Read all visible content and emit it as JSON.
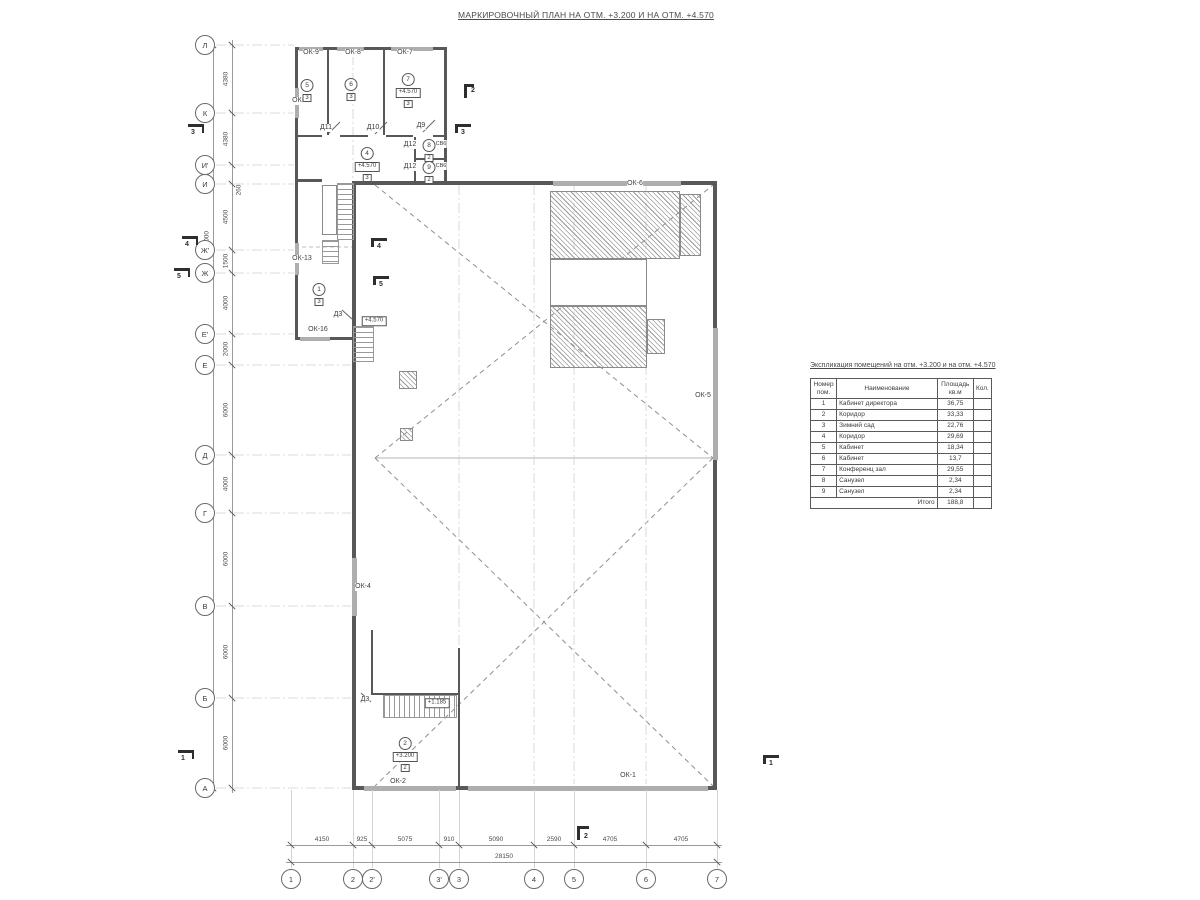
{
  "drawing_title": "МАРКИРОВОЧНЫЙ ПЛАН НА ОТМ. +3.200 И НА ОТМ. +4.570",
  "axes": {
    "left": [
      {
        "label": "Л",
        "y": 45
      },
      {
        "label": "К",
        "y": 113
      },
      {
        "label": "И'",
        "y": 165
      },
      {
        "label": "И",
        "y": 184
      },
      {
        "label": "Ж'",
        "y": 250
      },
      {
        "label": "Ж",
        "y": 273
      },
      {
        "label": "Е'",
        "y": 334
      },
      {
        "label": "Е",
        "y": 365
      },
      {
        "label": "Д",
        "y": 455
      },
      {
        "label": "Г",
        "y": 513
      },
      {
        "label": "В",
        "y": 606
      },
      {
        "label": "Б",
        "y": 698
      },
      {
        "label": "А",
        "y": 788
      }
    ],
    "bottom": [
      {
        "label": "1",
        "x": 291
      },
      {
        "label": "2",
        "x": 353
      },
      {
        "label": "2'",
        "x": 372
      },
      {
        "label": "3'",
        "x": 439
      },
      {
        "label": "3",
        "x": 459
      },
      {
        "label": "4",
        "x": 534
      },
      {
        "label": "5",
        "x": 574
      },
      {
        "label": "6",
        "x": 646
      },
      {
        "label": "7",
        "x": 717
      }
    ]
  },
  "dimensions": {
    "left_chain": [
      {
        "v": "4380",
        "y": 79
      },
      {
        "v": "4380",
        "y": 139
      },
      {
        "v": "260",
        "y": 190,
        "x": 239
      },
      {
        "v": "4500",
        "y": 217
      },
      {
        "v": "1500",
        "y": 261
      },
      {
        "v": "4000",
        "y": 303
      },
      {
        "v": "2000",
        "y": 349
      },
      {
        "v": "6000",
        "y": 410
      },
      {
        "v": "4000",
        "y": 484
      },
      {
        "v": "6000",
        "y": 559
      },
      {
        "v": "6000",
        "y": 652
      },
      {
        "v": "6000",
        "y": 743
      }
    ],
    "left_overall": {
      "v": "48000",
      "y": 240
    },
    "bottom_chain": [
      {
        "v": "4150",
        "x": 322
      },
      {
        "v": "925",
        "x": 362
      },
      {
        "v": "5075",
        "x": 405
      },
      {
        "v": "910",
        "x": 449
      },
      {
        "v": "5090",
        "x": 496
      },
      {
        "v": "2590",
        "x": 554
      },
      {
        "v": "4705",
        "x": 610
      },
      {
        "v": "4705",
        "x": 681
      }
    ],
    "bottom_overall": {
      "v": "28150",
      "x": 504
    }
  },
  "window_marks": [
    {
      "label": "ОК-9",
      "x": 311,
      "y": 53
    },
    {
      "label": "ОК-8",
      "x": 353,
      "y": 53
    },
    {
      "label": "ОК-7",
      "x": 405,
      "y": 53
    },
    {
      "label": "ОК-12",
      "x": 302,
      "y": 101
    },
    {
      "label": "ОК-13",
      "x": 302,
      "y": 259
    },
    {
      "label": "ОК-16",
      "x": 318,
      "y": 330
    },
    {
      "label": "ОК-6",
      "x": 635,
      "y": 184
    },
    {
      "label": "ОК-5",
      "x": 703,
      "y": 396
    },
    {
      "label": "ОК-4",
      "x": 363,
      "y": 587
    },
    {
      "label": "ОК-2",
      "x": 398,
      "y": 782
    },
    {
      "label": "ОК-1",
      "x": 628,
      "y": 776
    }
  ],
  "door_marks": [
    {
      "label": "Д11",
      "x": 326,
      "y": 128
    },
    {
      "label": "Д10",
      "x": 373,
      "y": 128
    },
    {
      "label": "Д9",
      "x": 421,
      "y": 126
    },
    {
      "label": "Д12",
      "x": 410,
      "y": 145
    },
    {
      "label": "Д12",
      "x": 410,
      "y": 167
    },
    {
      "label": "Д3",
      "x": 338,
      "y": 315
    },
    {
      "label": "Д3",
      "x": 365,
      "y": 700
    }
  ],
  "vent_marks": [
    {
      "label": "СВ6",
      "x": 441,
      "y": 144
    },
    {
      "label": "СВ6",
      "x": 441,
      "y": 166
    }
  ],
  "room_markers": [
    {
      "num": "5",
      "x": 307,
      "y": 79,
      "floor": "3"
    },
    {
      "num": "6",
      "x": 351,
      "y": 78,
      "floor": "3"
    },
    {
      "num": "7",
      "x": 408,
      "y": 73,
      "elev": "+4.570",
      "floor": "3"
    },
    {
      "num": "4",
      "x": 367,
      "y": 147,
      "elev": "+4.570",
      "floor": "3"
    },
    {
      "num": "8",
      "x": 429,
      "y": 139,
      "floor": "2"
    },
    {
      "num": "9",
      "x": 429,
      "y": 161,
      "floor": "2"
    },
    {
      "num": "1",
      "x": 319,
      "y": 283,
      "floor": "3"
    },
    {
      "num": "2",
      "x": 405,
      "y": 737,
      "elev": "+3.200",
      "floor": "2"
    }
  ],
  "elevation_marks": [
    {
      "v": "+4.570",
      "x": 374,
      "y": 321
    },
    {
      "v": "+1.185",
      "x": 437,
      "y": 703
    }
  ],
  "section_marks": [
    {
      "num": "2",
      "x": 464,
      "y": 84,
      "o": "top"
    },
    {
      "num": "3",
      "x": 188,
      "y": 124,
      "o": "left"
    },
    {
      "num": "3",
      "x": 455,
      "y": 124,
      "o": "right"
    },
    {
      "num": "4",
      "x": 182,
      "y": 236,
      "o": "left"
    },
    {
      "num": "4",
      "x": 371,
      "y": 238,
      "o": "right"
    },
    {
      "num": "5",
      "x": 174,
      "y": 268,
      "o": "left"
    },
    {
      "num": "5",
      "x": 373,
      "y": 276,
      "o": "right"
    },
    {
      "num": "1",
      "x": 178,
      "y": 750,
      "o": "left"
    },
    {
      "num": "1",
      "x": 763,
      "y": 755,
      "o": "right"
    },
    {
      "num": "2",
      "x": 577,
      "y": 826,
      "o": "bottom"
    }
  ],
  "legend_table": {
    "title": "Экспликация помещений на отм. +3.200 и на отм. +4.570",
    "col_num": "Номер пом.",
    "col_name": "Наименование",
    "col_area": "Площадь кв.м",
    "col_qty": "Кол.",
    "rows": [
      [
        "1",
        "Кабинет директора",
        "36,75"
      ],
      [
        "2",
        "Коридор",
        "33,33"
      ],
      [
        "3",
        "Зимний сад",
        "22,76"
      ],
      [
        "4",
        "Коридор",
        "29,69"
      ],
      [
        "5",
        "Кабинет",
        "18,34"
      ],
      [
        "6",
        "Кабинет",
        "13,7"
      ],
      [
        "7",
        "Конференц зал",
        "29,55"
      ],
      [
        "8",
        "Санузел",
        "2,34"
      ],
      [
        "9",
        "Санузел",
        "2,34"
      ]
    ],
    "total_label": "Итого",
    "total_value": "188,8"
  }
}
